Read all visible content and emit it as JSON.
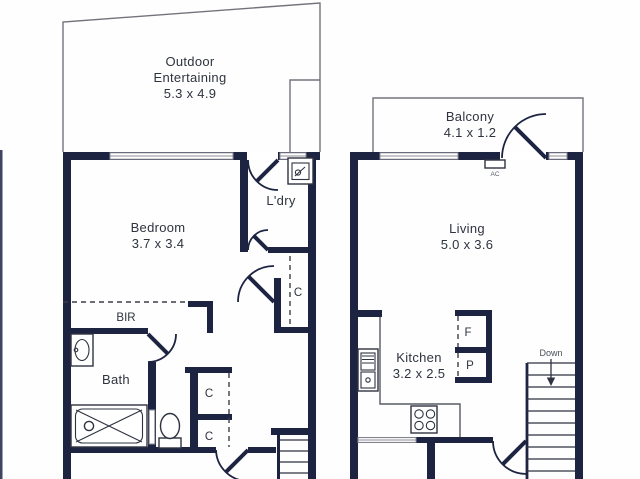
{
  "colors": {
    "wall": "#1d2442",
    "text": "#2e333e",
    "fixture_line": "#2f3340",
    "thin_outline": "#73737b",
    "window_frame": "#8c8c94",
    "background": "#ffffff"
  },
  "left_unit": {
    "outdoor": {
      "line1": "Outdoor",
      "line2": "Entertaining",
      "dims": "5.3 x 4.9"
    },
    "bedroom": {
      "name": "Bedroom",
      "dims": "3.7 x 3.4"
    },
    "laundry": {
      "name": "L'dry"
    },
    "hall_cupboard": {
      "name": "C"
    },
    "bir": {
      "name": "BIR"
    },
    "bath": {
      "name": "Bath"
    },
    "upper_cupboard": {
      "name": "C"
    },
    "lower_cupboard": {
      "name": "C"
    }
  },
  "right_unit": {
    "balcony": {
      "name": "Balcony",
      "dims": "4.1 x 1.2"
    },
    "ac": {
      "label": "AC"
    },
    "living": {
      "name": "Living",
      "dims": "5.0 x 3.6"
    },
    "kitchen": {
      "name": "Kitchen",
      "dims": "3.2 x 2.5"
    },
    "fridge": {
      "label": "F"
    },
    "pantry": {
      "label": "P"
    },
    "stairs": {
      "label": "Down"
    }
  }
}
